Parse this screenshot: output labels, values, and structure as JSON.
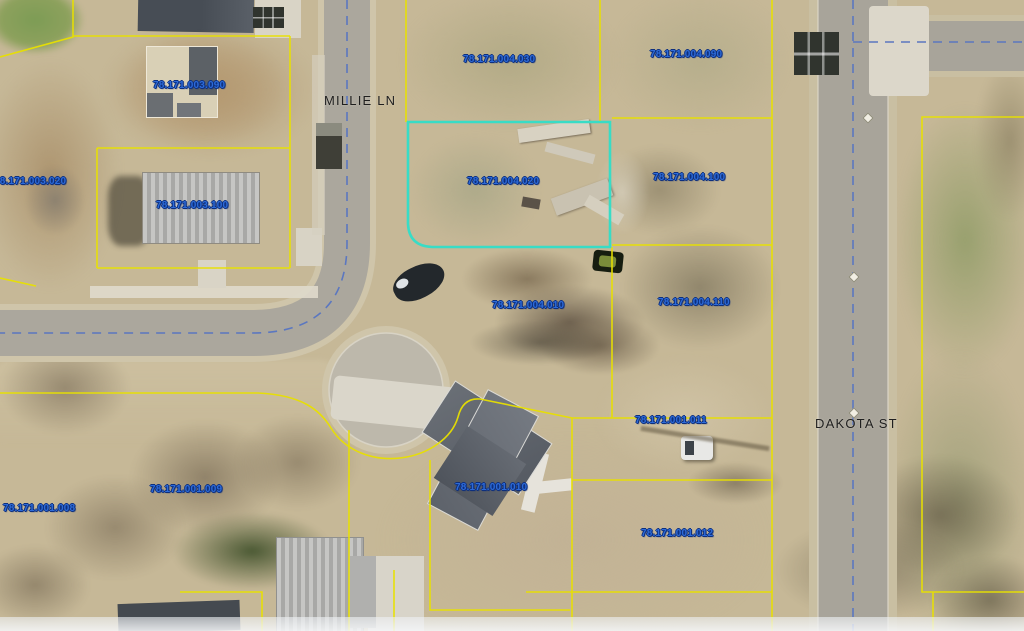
{
  "map": {
    "type": "aerial-parcel-map",
    "selected_parcel": "78.171.004.020",
    "colors": {
      "parcel_line": "#e8e000",
      "highlight": "#38dcc6",
      "parcel_label": "#2d6bd8",
      "street_label": "#1f1f1f",
      "road_centerline": "#5b77c0"
    },
    "streets": [
      {
        "name": "MILLIE LN"
      },
      {
        "name": "DAKOTA ST"
      }
    ],
    "parcels": [
      {
        "id": "78.171.003.090"
      },
      {
        "id": "78.171.003.020"
      },
      {
        "id": "78.171.003.100"
      },
      {
        "id": "78.171.004.030"
      },
      {
        "id": "78.171.004.090"
      },
      {
        "id": "78.171.004.020",
        "highlighted": true
      },
      {
        "id": "78.171.004.100"
      },
      {
        "id": "78.171.004.010"
      },
      {
        "id": "78.171.004.110"
      },
      {
        "id": "78.171.001.011"
      },
      {
        "id": "78.171.001.009"
      },
      {
        "id": "78.171.001.008"
      },
      {
        "id": "78.171.001.010"
      },
      {
        "id": "78.171.001.012"
      }
    ]
  }
}
